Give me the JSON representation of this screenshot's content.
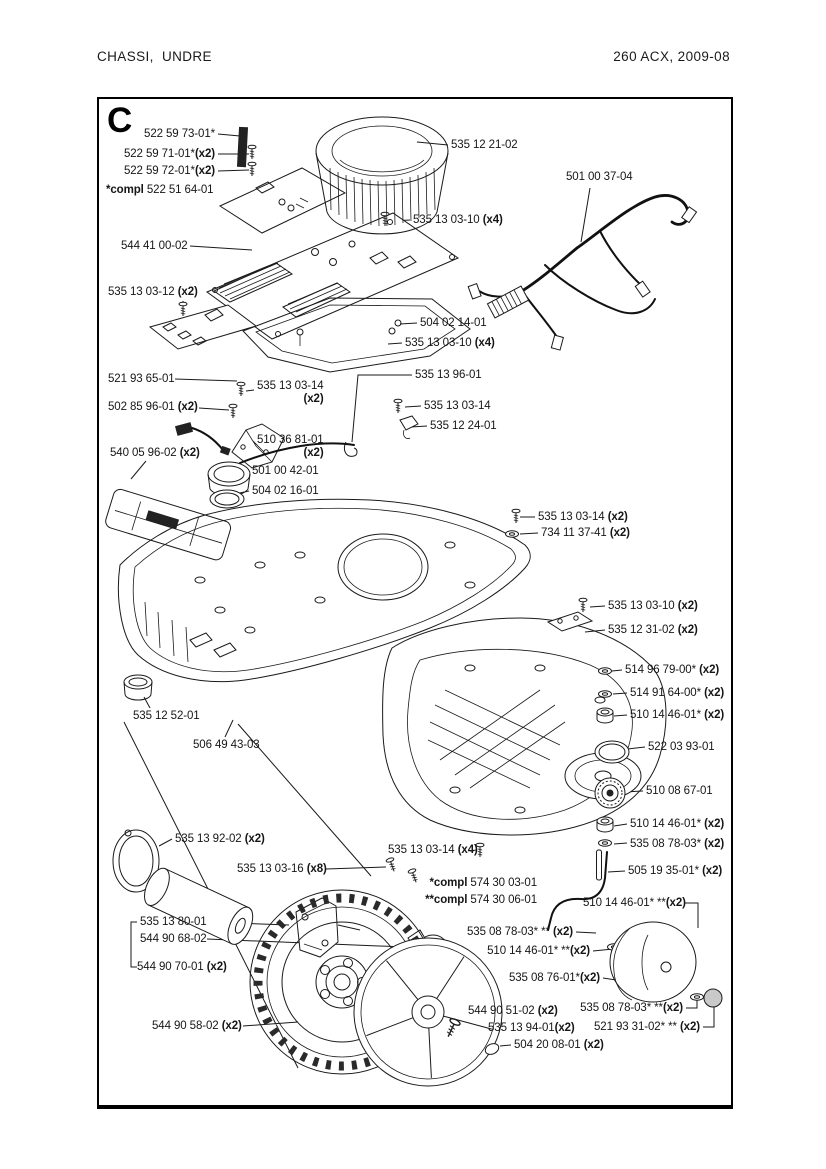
{
  "page": {
    "header_left": "CHASSI, UNDRE",
    "header_right": "260 ACX, 2009-08"
  },
  "colors": {
    "line": "#1a1a1a",
    "background": "#ffffff"
  },
  "diagram": {
    "section_letter": "C",
    "labels": [
      {
        "num": "522 59 73-01*",
        "x": 215,
        "y": 128,
        "align": "right"
      },
      {
        "num": "522 59 71-01*",
        "qty": "(x2)",
        "tight": true,
        "x": 215,
        "y": 148,
        "align": "right"
      },
      {
        "num": "522 59 72-01*",
        "qty": "(x2)",
        "tight": true,
        "x": 215,
        "y": 165,
        "align": "right"
      },
      {
        "prefix": "*compl",
        "num": "522 51 64-01",
        "x": 106,
        "y": 184,
        "align": "left"
      },
      {
        "num": "535 12 21-02",
        "x": 451,
        "y": 139,
        "align": "left"
      },
      {
        "num": "501 00 37-04",
        "x": 566,
        "y": 171,
        "align": "left"
      },
      {
        "num": "535 13 03-10",
        "qty": "(x4)",
        "x": 413,
        "y": 214,
        "align": "left"
      },
      {
        "num": "544 41 00-02",
        "x": 121,
        "y": 240,
        "align": "left"
      },
      {
        "num": "535 13 03-12",
        "qty": "(x2)",
        "x": 108,
        "y": 286,
        "align": "left"
      },
      {
        "num": "504 02 14-01",
        "x": 420,
        "y": 317,
        "align": "left"
      },
      {
        "num": "535 13 03-10",
        "qty": "(x4)",
        "x": 405,
        "y": 337,
        "align": "left"
      },
      {
        "num": "535 13 96-01",
        "x": 415,
        "y": 369,
        "align": "left"
      },
      {
        "num": "521 93 65-01",
        "x": 108,
        "y": 373,
        "align": "left"
      },
      {
        "num": "535 13 03-14",
        "qty": "(x2)",
        "two_line": true,
        "x": 257,
        "y": 380,
        "align": "left"
      },
      {
        "num": "502 85 96-01",
        "qty": "(x2)",
        "x": 108,
        "y": 401,
        "align": "left"
      },
      {
        "num": "535 13 03-14",
        "x": 424,
        "y": 400,
        "align": "left"
      },
      {
        "num": "535 12 24-01",
        "x": 430,
        "y": 420,
        "align": "left"
      },
      {
        "num": "510 36 81-01",
        "qty": "(x2)",
        "two_line": true,
        "x": 257,
        "y": 434,
        "align": "left"
      },
      {
        "num": "540 05 96-02",
        "qty": "(x2)",
        "x": 110,
        "y": 447,
        "align": "left"
      },
      {
        "num": "501 00 42-01",
        "x": 252,
        "y": 465,
        "align": "left"
      },
      {
        "num": "504 02 16-01",
        "x": 252,
        "y": 485,
        "align": "left"
      },
      {
        "num": "535 13 03-14",
        "qty": "(x2)",
        "x": 538,
        "y": 511,
        "align": "left"
      },
      {
        "num": "734 11 37-41",
        "qty": "(x2)",
        "x": 541,
        "y": 527,
        "align": "left"
      },
      {
        "num": "535 13 03-10",
        "qty": "(x2)",
        "x": 608,
        "y": 600,
        "align": "left"
      },
      {
        "num": "535 12 31-02",
        "qty": "(x2)",
        "x": 608,
        "y": 624,
        "align": "left"
      },
      {
        "num": "514 96 79-00*",
        "qty": "(x2)",
        "x": 625,
        "y": 664,
        "align": "left"
      },
      {
        "num": "514 91 64-00*",
        "qty": "(x2)",
        "x": 630,
        "y": 687,
        "align": "left"
      },
      {
        "num": "510 14 46-01*",
        "qty": "(x2)",
        "x": 630,
        "y": 709,
        "align": "left"
      },
      {
        "num": "535 12 52-01",
        "x": 133,
        "y": 710,
        "align": "left"
      },
      {
        "num": "506 49 43-03",
        "x": 193,
        "y": 739,
        "align": "left"
      },
      {
        "num": "522 03 93-01",
        "x": 648,
        "y": 741,
        "align": "left"
      },
      {
        "num": "510 08 67-01",
        "x": 646,
        "y": 785,
        "align": "left"
      },
      {
        "num": "510 14 46-01*",
        "qty": "(x2)",
        "x": 630,
        "y": 818,
        "align": "left"
      },
      {
        "num": "535 08 78-03*",
        "qty": "(x2)",
        "x": 630,
        "y": 838,
        "align": "left"
      },
      {
        "num": "505 19 35-01*",
        "qty": "(x2)",
        "x": 628,
        "y": 865,
        "align": "left"
      },
      {
        "num": "535 13 92-02",
        "qty": "(x2)",
        "x": 175,
        "y": 833,
        "align": "left"
      },
      {
        "num": "535 13 03-14",
        "qty": "(x4)",
        "x": 388,
        "y": 844,
        "align": "left"
      },
      {
        "num": "535 13 03-16",
        "qty": "(x8)",
        "x": 237,
        "y": 863,
        "align": "left"
      },
      {
        "prefix": "*compl",
        "num": "574 30 03-01",
        "x": 537,
        "y": 877,
        "align": "right"
      },
      {
        "prefix": "**compl",
        "num": "574 30 06-01",
        "x": 537,
        "y": 894,
        "align": "right"
      },
      {
        "num": "510 14 46-01* **",
        "qty": "(x2)",
        "tight": true,
        "x": 583,
        "y": 897,
        "align": "left"
      },
      {
        "num": "535 13 80-01",
        "x": 140,
        "y": 916,
        "align": "left"
      },
      {
        "num": "544 90 68-02",
        "x": 140,
        "y": 933,
        "align": "left"
      },
      {
        "num": "535 08 78-03* **",
        "qty": "(x2)",
        "x": 573,
        "y": 926,
        "align": "right"
      },
      {
        "num": "510 14 46-01* **",
        "qty": "(x2)",
        "tight": true,
        "x": 590,
        "y": 945,
        "align": "right"
      },
      {
        "num": "544 90 70-01",
        "qty": "(x2)",
        "x": 137,
        "y": 961,
        "align": "left"
      },
      {
        "num": "535 08 76-01*",
        "qty": "(x2)",
        "tight": true,
        "x": 600,
        "y": 972,
        "align": "right"
      },
      {
        "num": "544 90 51-02",
        "qty": "(x2)",
        "x": 468,
        "y": 1005,
        "align": "left"
      },
      {
        "num": "535 08 78-03* **",
        "qty": "(x2)",
        "tight": true,
        "x": 683,
        "y": 1002,
        "align": "right"
      },
      {
        "num": "544 90 58-02",
        "qty": "(x2)",
        "x": 152,
        "y": 1020,
        "align": "left"
      },
      {
        "num": "535 13 94-01",
        "qty": "(x2)",
        "tight": true,
        "x": 488,
        "y": 1022,
        "align": "left"
      },
      {
        "num": "521 93 31-02* **",
        "qty": "(x2)",
        "x": 700,
        "y": 1021,
        "align": "right"
      },
      {
        "num": "504 20 08-01",
        "qty": "(x2)",
        "x": 514,
        "y": 1039,
        "align": "left"
      }
    ]
  }
}
